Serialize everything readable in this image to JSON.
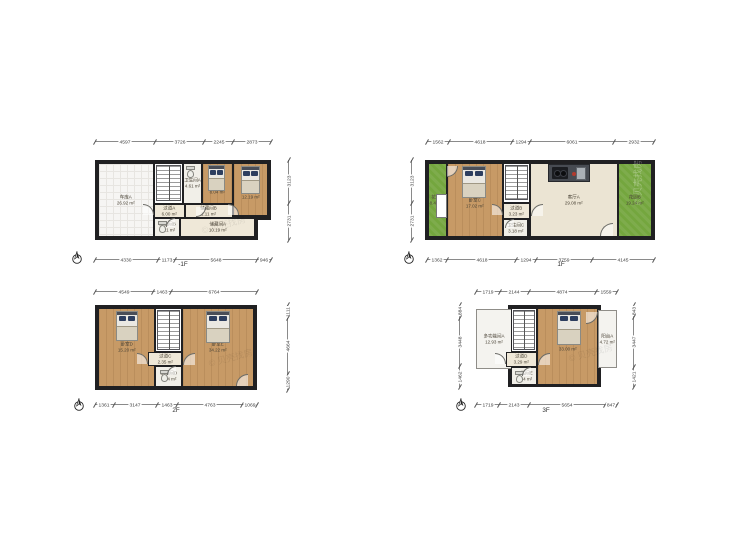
{
  "meta": {
    "sheet_title": "户型图",
    "unit": "m²"
  },
  "colors": {
    "wall": "#202022",
    "wood": "#c79a66",
    "green": "#74a63e",
    "cream": "#efe8d8",
    "dim_line": "#8a8a8a",
    "label": "#4a4336"
  },
  "watermark": {
    "text": "贝壳找房"
  },
  "plans": [
    {
      "id": "b1f",
      "label": "-1F",
      "frames": [
        {
          "x": 95,
          "y": 160,
          "w": 176,
          "h": 60
        },
        {
          "x": 95,
          "y": 216,
          "w": 163,
          "h": 24
        }
      ],
      "rooms": [
        {
          "name": "车库A",
          "area": "26.92 m²",
          "x": 98,
          "y": 163,
          "w": 56,
          "h": 74,
          "fill": "tile"
        },
        {
          "x": 154,
          "y": 163,
          "w": 29,
          "h": 41,
          "fill": "white"
        },
        {
          "name": "卫生间A",
          "area": "4.61 m²",
          "x": 183,
          "y": 163,
          "w": 19,
          "h": 41,
          "fill": "bath"
        },
        {
          "name": "卧室A",
          "area": "8.04 m²",
          "x": 202,
          "y": 163,
          "w": 31,
          "h": 41,
          "fill": "wood",
          "ldy": 12
        },
        {
          "name": "卧室B",
          "area": "12.19 m²",
          "x": 233,
          "y": 163,
          "w": 35,
          "h": 53,
          "fill": "wood",
          "ldy": 10
        },
        {
          "name": "过道A",
          "area": "6.00 m²",
          "x": 154,
          "y": 204,
          "w": 31,
          "h": 14,
          "fill": "cream"
        },
        {
          "name": "储藏间B",
          "area": "1.11 m²",
          "x": 185,
          "y": 204,
          "w": 48,
          "h": 14,
          "fill": "cream"
        },
        {
          "name": "卫生间B",
          "area": "3.21 m²",
          "x": 154,
          "y": 218,
          "w": 26,
          "h": 19,
          "fill": "bath"
        },
        {
          "name": "储藏间A",
          "area": "10.19 m²",
          "x": 180,
          "y": 218,
          "w": 75,
          "h": 19,
          "fill": "cream"
        }
      ],
      "features": [
        {
          "type": "stairs",
          "x": 156,
          "y": 165,
          "w": 25,
          "h": 36
        },
        {
          "type": "toilet",
          "x": 186,
          "y": 166,
          "w": 9,
          "h": 12
        },
        {
          "type": "bed",
          "x": 208,
          "y": 165,
          "w": 17,
          "h": 26
        },
        {
          "type": "bed",
          "x": 241,
          "y": 166,
          "w": 19,
          "h": 28
        },
        {
          "type": "toilet",
          "x": 158,
          "y": 221,
          "w": 9,
          "h": 12
        },
        {
          "type": "door",
          "x": 143,
          "y": 204,
          "w": 11,
          "h": 11,
          "c": "tr"
        },
        {
          "type": "door",
          "x": 196,
          "y": 207,
          "w": 10,
          "h": 10,
          "c": "br"
        },
        {
          "type": "door",
          "x": 166,
          "y": 218,
          "w": 9,
          "h": 9,
          "c": "tl"
        },
        {
          "type": "door",
          "x": 228,
          "y": 204,
          "w": 11,
          "h": 11,
          "c": "tr"
        },
        {
          "type": "wm",
          "x": 200,
          "y": 224,
          "rot": -15
        }
      ],
      "dims": [
        {
          "side": "top",
          "x": 95,
          "y": 141,
          "len": 176,
          "values": [
            "4597",
            "3726",
            "2245",
            "2873"
          ]
        },
        {
          "side": "bottom",
          "x": 95,
          "y": 259,
          "len": 176,
          "values": [
            "4330",
            "1173",
            "5648",
            "946"
          ]
        },
        {
          "side": "right",
          "x": 288,
          "y": 160,
          "len": 80,
          "values": [
            "3123",
            "2731"
          ]
        }
      ],
      "compass": {
        "x": 77,
        "y": 258
      },
      "floor_label": {
        "x": 183,
        "y": 264
      }
    },
    {
      "id": "f1",
      "label": "1F",
      "frames": [
        {
          "x": 425,
          "y": 160,
          "w": 230,
          "h": 80
        }
      ],
      "rooms": [
        {
          "name": "花园A",
          "area": "8.44 m²",
          "x": 428,
          "y": 163,
          "w": 19,
          "h": 74,
          "fill": "green"
        },
        {
          "name": "卧室C",
          "area": "17.02 m²",
          "x": 447,
          "y": 163,
          "w": 56,
          "h": 74,
          "fill": "wood",
          "ldy": 6
        },
        {
          "x": 503,
          "y": 163,
          "w": 27,
          "h": 40,
          "fill": "white"
        },
        {
          "name": "过道B",
          "area": "3.23 m²",
          "x": 503,
          "y": 203,
          "w": 27,
          "h": 16,
          "fill": "cream"
        },
        {
          "name": "卫生间C",
          "area": "3.18 m²",
          "x": 503,
          "y": 219,
          "w": 25,
          "h": 18,
          "fill": "bath"
        },
        {
          "name": "客厅A",
          "area": "29.08 m²",
          "x": 530,
          "y": 163,
          "w": 88,
          "h": 74,
          "fill": "living"
        },
        {
          "name": "花园B",
          "area": "19.24 m²",
          "x": 618,
          "y": 163,
          "w": 34,
          "h": 74,
          "fill": "green"
        }
      ],
      "features": [
        {
          "type": "window",
          "x": 436,
          "y": 194,
          "w": 11,
          "h": 24
        },
        {
          "type": "bed",
          "x": 462,
          "y": 166,
          "w": 24,
          "h": 32
        },
        {
          "type": "stairs",
          "x": 505,
          "y": 165,
          "w": 23,
          "h": 35
        },
        {
          "type": "kitchen",
          "x": 548,
          "y": 164,
          "w": 42,
          "h": 18
        },
        {
          "type": "door",
          "x": 447,
          "y": 166,
          "w": 11,
          "h": 11,
          "c": "br"
        },
        {
          "type": "door",
          "x": 492,
          "y": 204,
          "w": 11,
          "h": 11,
          "c": "tr"
        },
        {
          "type": "door",
          "x": 531,
          "y": 204,
          "w": 12,
          "h": 12,
          "c": "tl"
        },
        {
          "type": "door",
          "x": 505,
          "y": 219,
          "w": 9,
          "h": 9,
          "c": "tl"
        },
        {
          "type": "door",
          "x": 600,
          "y": 223,
          "w": 13,
          "h": 13,
          "c": "tl"
        },
        {
          "type": "wm",
          "x": 631,
          "y": 205,
          "rot": -90,
          "light": true
        }
      ],
      "dims": [
        {
          "side": "top",
          "x": 427,
          "y": 141,
          "len": 227,
          "values": [
            "1562",
            "4618",
            "1294",
            "6061",
            "2932"
          ]
        },
        {
          "side": "bottom",
          "x": 427,
          "y": 259,
          "len": 227,
          "values": [
            "1362",
            "4618",
            "1294",
            "3759",
            "4145"
          ]
        },
        {
          "side": "left",
          "x": 411,
          "y": 160,
          "len": 80,
          "values": [
            "3123",
            "2731"
          ]
        }
      ],
      "compass": {
        "x": 409,
        "y": 258
      },
      "floor_label": {
        "x": 561,
        "y": 264
      }
    },
    {
      "id": "f2",
      "label": "2F",
      "frames": [
        {
          "x": 95,
          "y": 305,
          "w": 162,
          "h": 85
        }
      ],
      "rooms": [
        {
          "name": "卧室D",
          "area": "15.20 m²",
          "x": 98,
          "y": 308,
          "w": 57,
          "h": 79,
          "fill": "wood"
        },
        {
          "x": 155,
          "y": 308,
          "w": 27,
          "h": 44,
          "fill": "white"
        },
        {
          "name": "过道C",
          "area": "2.35 m²",
          "x": 148,
          "y": 352,
          "w": 34,
          "h": 14,
          "fill": "cream"
        },
        {
          "name": "卫生间D",
          "area": "3.34 m²",
          "x": 155,
          "y": 366,
          "w": 27,
          "h": 21,
          "fill": "bath"
        },
        {
          "name": "卧室E",
          "area": "34.22 m²",
          "x": 182,
          "y": 308,
          "w": 72,
          "h": 79,
          "fill": "wood"
        }
      ],
      "features": [
        {
          "type": "bed",
          "x": 116,
          "y": 311,
          "w": 22,
          "h": 30
        },
        {
          "type": "bed",
          "x": 206,
          "y": 311,
          "w": 24,
          "h": 32
        },
        {
          "type": "stairs",
          "x": 157,
          "y": 310,
          "w": 23,
          "h": 40
        },
        {
          "type": "toilet",
          "x": 160,
          "y": 370,
          "w": 9,
          "h": 12
        },
        {
          "type": "door",
          "x": 137,
          "y": 353,
          "w": 11,
          "h": 11,
          "c": "tr"
        },
        {
          "type": "door",
          "x": 183,
          "y": 353,
          "w": 12,
          "h": 12,
          "c": "tl"
        },
        {
          "type": "door",
          "x": 167,
          "y": 366,
          "w": 9,
          "h": 9,
          "c": "tl"
        },
        {
          "type": "door",
          "x": 236,
          "y": 374,
          "w": 12,
          "h": 12,
          "c": "tl"
        },
        {
          "type": "wm",
          "x": 207,
          "y": 357,
          "rot": -15
        }
      ],
      "dims": [
        {
          "side": "top",
          "x": 95,
          "y": 291,
          "len": 162,
          "values": [
            "4549",
            "1463",
            "6764"
          ]
        },
        {
          "side": "bottom",
          "x": 95,
          "y": 404,
          "len": 162,
          "values": [
            "1361",
            "3147",
            "1463",
            "4763",
            "1069"
          ]
        },
        {
          "side": "right",
          "x": 287,
          "y": 305,
          "len": 85,
          "values": [
            "1111",
            "4664",
            "1290"
          ]
        }
      ],
      "compass": {
        "x": 79,
        "y": 405
      },
      "floor_label": {
        "x": 176,
        "y": 410
      }
    },
    {
      "id": "f3",
      "label": "3F",
      "frames": [
        {
          "x": 508,
          "y": 305,
          "w": 93,
          "h": 82
        }
      ],
      "rooms": [
        {
          "name": "多功能间A",
          "area": "12.93 m²",
          "x": 476,
          "y": 309,
          "w": 36,
          "h": 60,
          "fill": "lite",
          "lite": true
        },
        {
          "x": 511,
          "y": 308,
          "w": 26,
          "h": 44,
          "fill": "white"
        },
        {
          "name": "过道D",
          "area": "3.29 m²",
          "x": 506,
          "y": 352,
          "w": 31,
          "h": 15,
          "fill": "cream"
        },
        {
          "name": "卫生间E",
          "area": "3.34 m²",
          "x": 511,
          "y": 367,
          "w": 26,
          "h": 18,
          "fill": "bath"
        },
        {
          "name": "卧室F",
          "area": "33.00 m²",
          "x": 537,
          "y": 308,
          "w": 61,
          "h": 77,
          "fill": "wood"
        },
        {
          "name": "阳台A",
          "area": "4.72 m²",
          "x": 598,
          "y": 310,
          "w": 19,
          "h": 58,
          "fill": "lite",
          "lite": true
        }
      ],
      "features": [
        {
          "type": "stairs",
          "x": 513,
          "y": 310,
          "w": 22,
          "h": 40
        },
        {
          "type": "bed",
          "x": 557,
          "y": 311,
          "w": 24,
          "h": 34
        },
        {
          "type": "toilet",
          "x": 515,
          "y": 371,
          "w": 9,
          "h": 12
        },
        {
          "type": "door",
          "x": 495,
          "y": 353,
          "w": 11,
          "h": 11,
          "c": "tr"
        },
        {
          "type": "door",
          "x": 538,
          "y": 353,
          "w": 12,
          "h": 12,
          "c": "tl"
        },
        {
          "type": "door",
          "x": 522,
          "y": 367,
          "w": 9,
          "h": 9,
          "c": "tl"
        },
        {
          "type": "door",
          "x": 586,
          "y": 312,
          "w": 12,
          "h": 12,
          "c": "br"
        },
        {
          "type": "wm",
          "x": 567,
          "y": 352,
          "rot": -15
        }
      ],
      "dims": [
        {
          "side": "top",
          "x": 476,
          "y": 291,
          "len": 141,
          "values": [
            "1719",
            "2144",
            "4874",
            "1559"
          ]
        },
        {
          "side": "bottom",
          "x": 476,
          "y": 404,
          "len": 141,
          "values": [
            "1719",
            "2143",
            "5654",
            "847"
          ]
        },
        {
          "side": "left",
          "x": 459,
          "y": 305,
          "len": 82,
          "values": [
            "884",
            "3448",
            "1462"
          ]
        },
        {
          "side": "right",
          "x": 633,
          "y": 305,
          "len": 82,
          "values": [
            "843",
            "3447",
            "1421"
          ]
        }
      ],
      "compass": {
        "x": 461,
        "y": 405
      },
      "floor_label": {
        "x": 546,
        "y": 410
      }
    }
  ]
}
